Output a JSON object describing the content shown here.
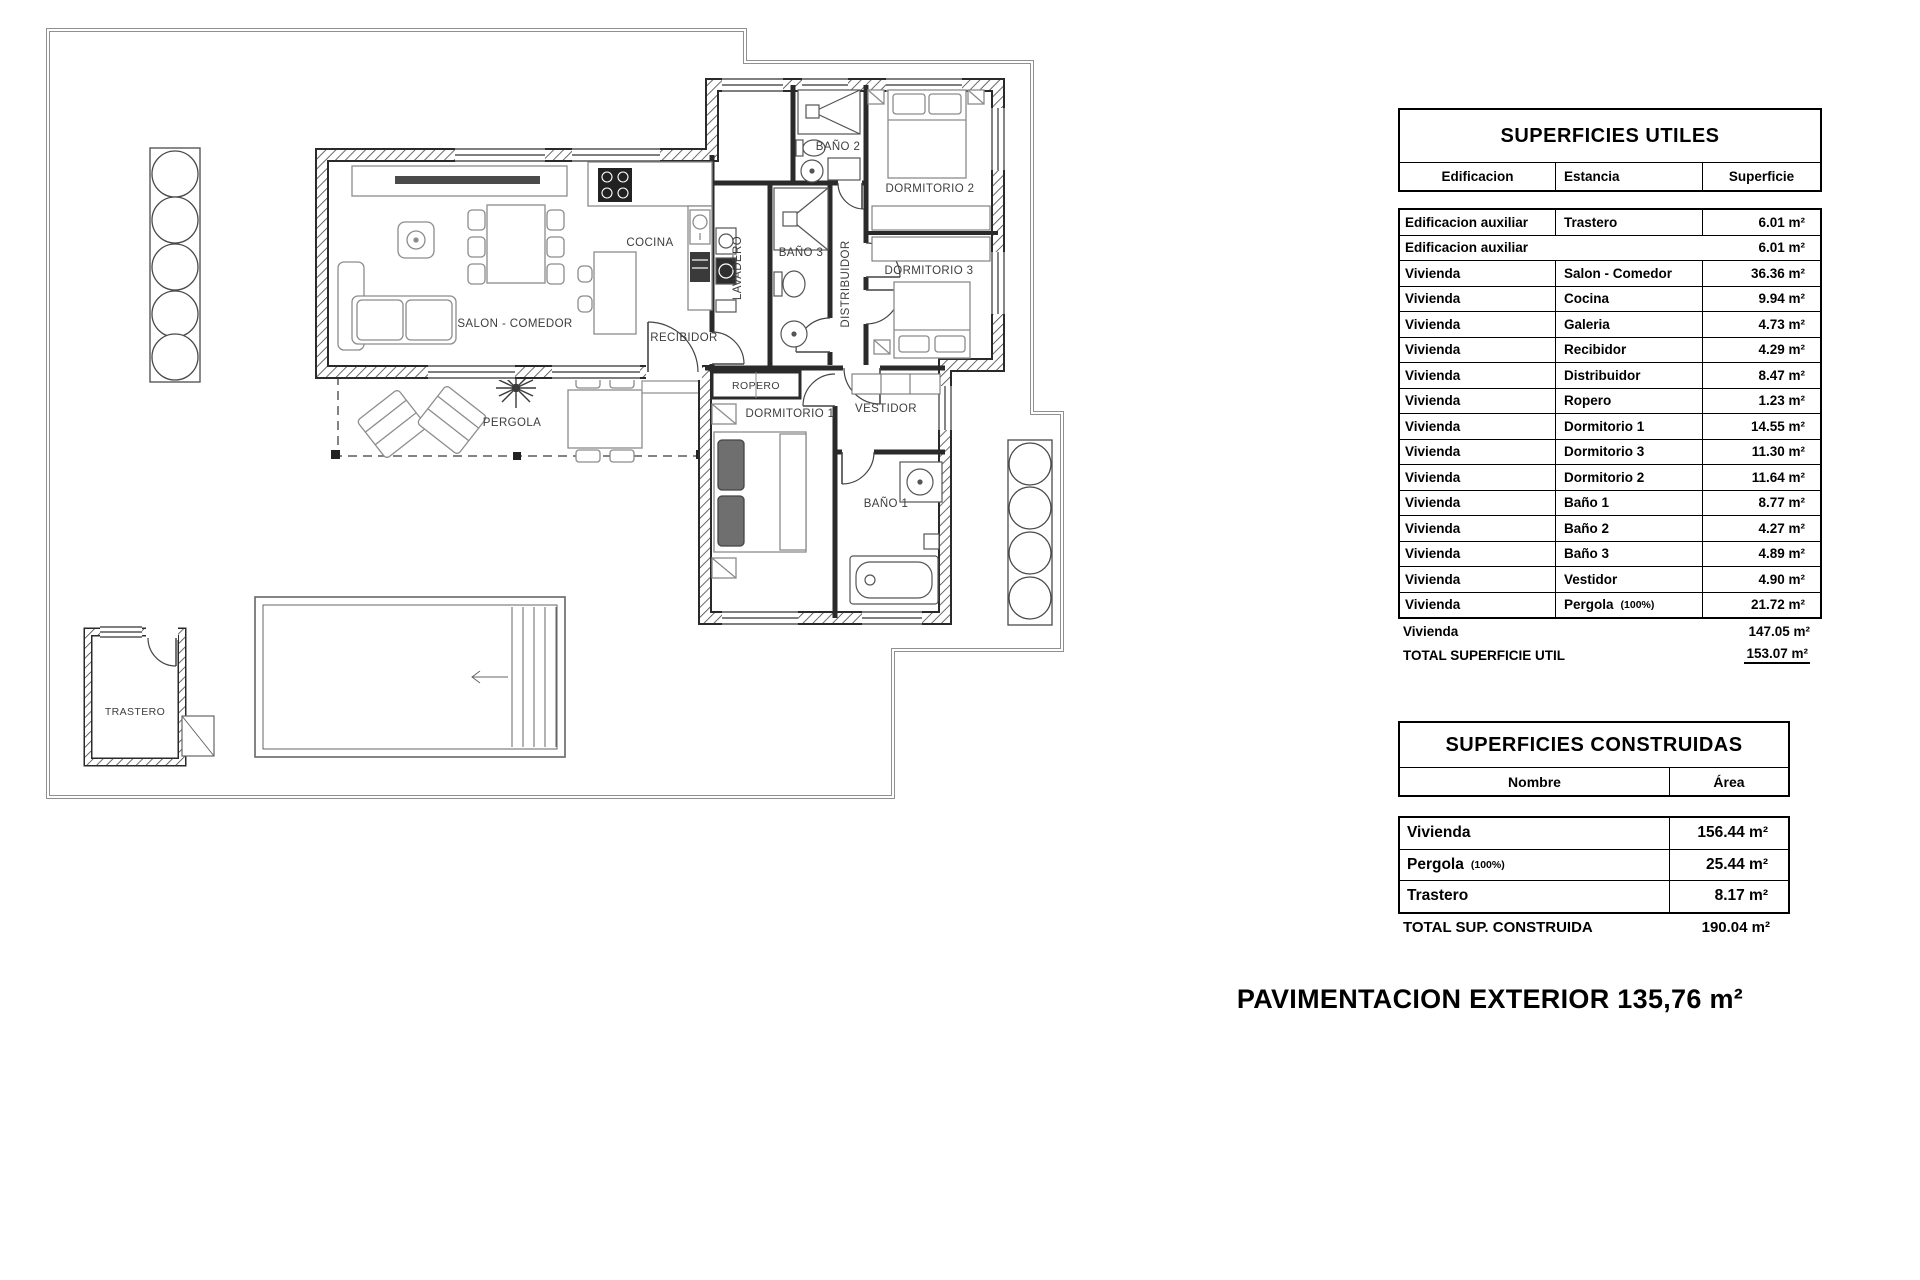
{
  "plan": {
    "rooms": [
      {
        "label": "SALON - COMEDOR"
      },
      {
        "label": "COCINA"
      },
      {
        "label": "LAVADERO"
      },
      {
        "label": "BAÑO 3"
      },
      {
        "label": "BAÑO 2"
      },
      {
        "label": "DORMITORIO 2"
      },
      {
        "label": "DORMITORIO 3"
      },
      {
        "label": "DISTRIBUIDOR"
      },
      {
        "label": "RECIBIDOR"
      },
      {
        "label": "ROPERO"
      },
      {
        "label": "PERGOLA"
      },
      {
        "label": "DORMITORIO 1"
      },
      {
        "label": "VESTIDOR"
      },
      {
        "label": "BAÑO 1"
      },
      {
        "label": "TRASTERO"
      }
    ]
  },
  "superficies_utiles": {
    "title": "SUPERFICIES UTILES",
    "columns": [
      "Edificacion",
      "Estancia",
      "Superficie"
    ],
    "rows": [
      {
        "edificacion": "Edificacion auxiliar",
        "estancia": "Trastero",
        "superficie": "6.01 m²"
      },
      {
        "edificacion": "Edificacion auxiliar",
        "estancia": "",
        "superficie": "6.01 m²"
      },
      {
        "edificacion": "Vivienda",
        "estancia": "Salon - Comedor",
        "superficie": "36.36 m²"
      },
      {
        "edificacion": "Vivienda",
        "estancia": "Cocina",
        "superficie": "9.94 m²"
      },
      {
        "edificacion": "Vivienda",
        "estancia": "Galeria",
        "superficie": "4.73 m²"
      },
      {
        "edificacion": "Vivienda",
        "estancia": "Recibidor",
        "superficie": "4.29 m²"
      },
      {
        "edificacion": "Vivienda",
        "estancia": "Distribuidor",
        "superficie": "8.47 m²"
      },
      {
        "edificacion": "Vivienda",
        "estancia": "Ropero",
        "superficie": "1.23 m²"
      },
      {
        "edificacion": "Vivienda",
        "estancia": "Dormitorio 1",
        "superficie": "14.55 m²"
      },
      {
        "edificacion": "Vivienda",
        "estancia": "Dormitorio 3",
        "superficie": "11.30 m²"
      },
      {
        "edificacion": "Vivienda",
        "estancia": "Dormitorio 2",
        "superficie": "11.64 m²"
      },
      {
        "edificacion": "Vivienda",
        "estancia": "Baño 1",
        "superficie": "8.77 m²"
      },
      {
        "edificacion": "Vivienda",
        "estancia": "Baño 2",
        "superficie": "4.27 m²"
      },
      {
        "edificacion": "Vivienda",
        "estancia": "Baño 3",
        "superficie": "4.89 m²"
      },
      {
        "edificacion": "Vivienda",
        "estancia": "Vestidor",
        "superficie": "4.90 m²"
      },
      {
        "edificacion": "Vivienda",
        "estancia": "Pergola",
        "note": "(100%)",
        "superficie": "21.72 m²"
      }
    ],
    "subtotal": {
      "label": "Vivienda",
      "value": "147.05 m²"
    },
    "total": {
      "label": "TOTAL SUPERFICIE UTIL",
      "value": "153.07 m²"
    }
  },
  "superficies_construidas": {
    "title": "SUPERFICIES CONSTRUIDAS",
    "columns": [
      "Nombre",
      "Área"
    ],
    "rows": [
      {
        "nombre": "Vivienda",
        "area": "156.44 m²"
      },
      {
        "nombre": "Pergola",
        "note": "(100%)",
        "area": "25.44 m²"
      },
      {
        "nombre": "Trastero",
        "area": "8.17 m²"
      }
    ],
    "total": {
      "label": "TOTAL SUP. CONSTRUIDA",
      "value": "190.04 m²"
    }
  },
  "footer": {
    "text": "PAVIMENTACION EXTERIOR 135,76 m²"
  }
}
